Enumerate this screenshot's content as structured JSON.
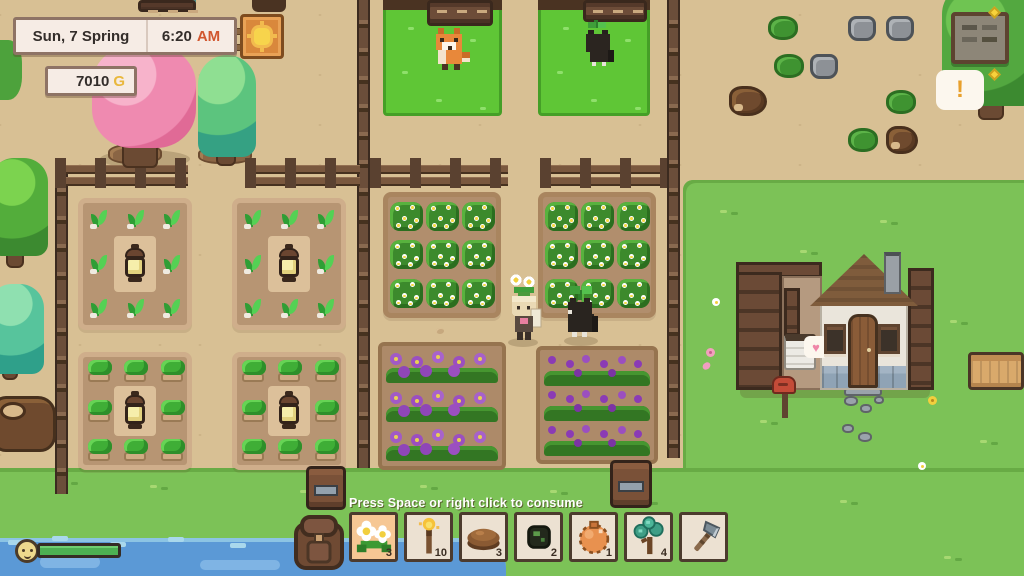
{
  "hud": {
    "date": "Sun, 7 Spring",
    "time": "6:20",
    "meridiem": "AM",
    "money": "7010",
    "currency": "G"
  },
  "tooltip": "Press Space or right click to consume",
  "hotbar": {
    "slots": [
      {
        "item": "daisy-flowers",
        "count": "3",
        "selected": true
      },
      {
        "item": "torch",
        "count": "10",
        "selected": false
      },
      {
        "item": "baked-pie",
        "count": "3",
        "selected": false
      },
      {
        "item": "dark-seed",
        "count": "2",
        "selected": false
      },
      {
        "item": "orange-pouch",
        "count": "1",
        "selected": false
      },
      {
        "item": "tree-sapling",
        "count": "4",
        "selected": false
      },
      {
        "item": "axe",
        "count": "",
        "selected": false
      }
    ]
  },
  "status": {
    "stamina_percent": 100
  },
  "notice": {
    "exclamation": "!"
  },
  "house": {
    "heart": "♥"
  },
  "colors": {
    "ground": "#d8c094",
    "grass_field": "#7cc257",
    "grass_pen": "#5fc636",
    "water": "#5b99d6",
    "ui_panel_bg": "#f6ece5",
    "ui_border": "#8e7365",
    "slot_bg": "#ece1d2",
    "slot_selected_bg": "#f6c794",
    "slot_border": "#4c3b2e",
    "am_accent": "#d1572f",
    "gold_accent": "#e9b83d"
  },
  "scene": {
    "entities": [
      "fox",
      "grazing-cat",
      "player-holding-flowers",
      "companion-cat",
      "sprout-plots",
      "sapling-plots",
      "flowering-bush-plots",
      "purple-flower-plots",
      "lanterns",
      "chests",
      "house",
      "bed",
      "mailbox",
      "notice-board",
      "bench",
      "cherry-blossom-tree",
      "animal-pens",
      "feeding-troughs"
    ]
  }
}
